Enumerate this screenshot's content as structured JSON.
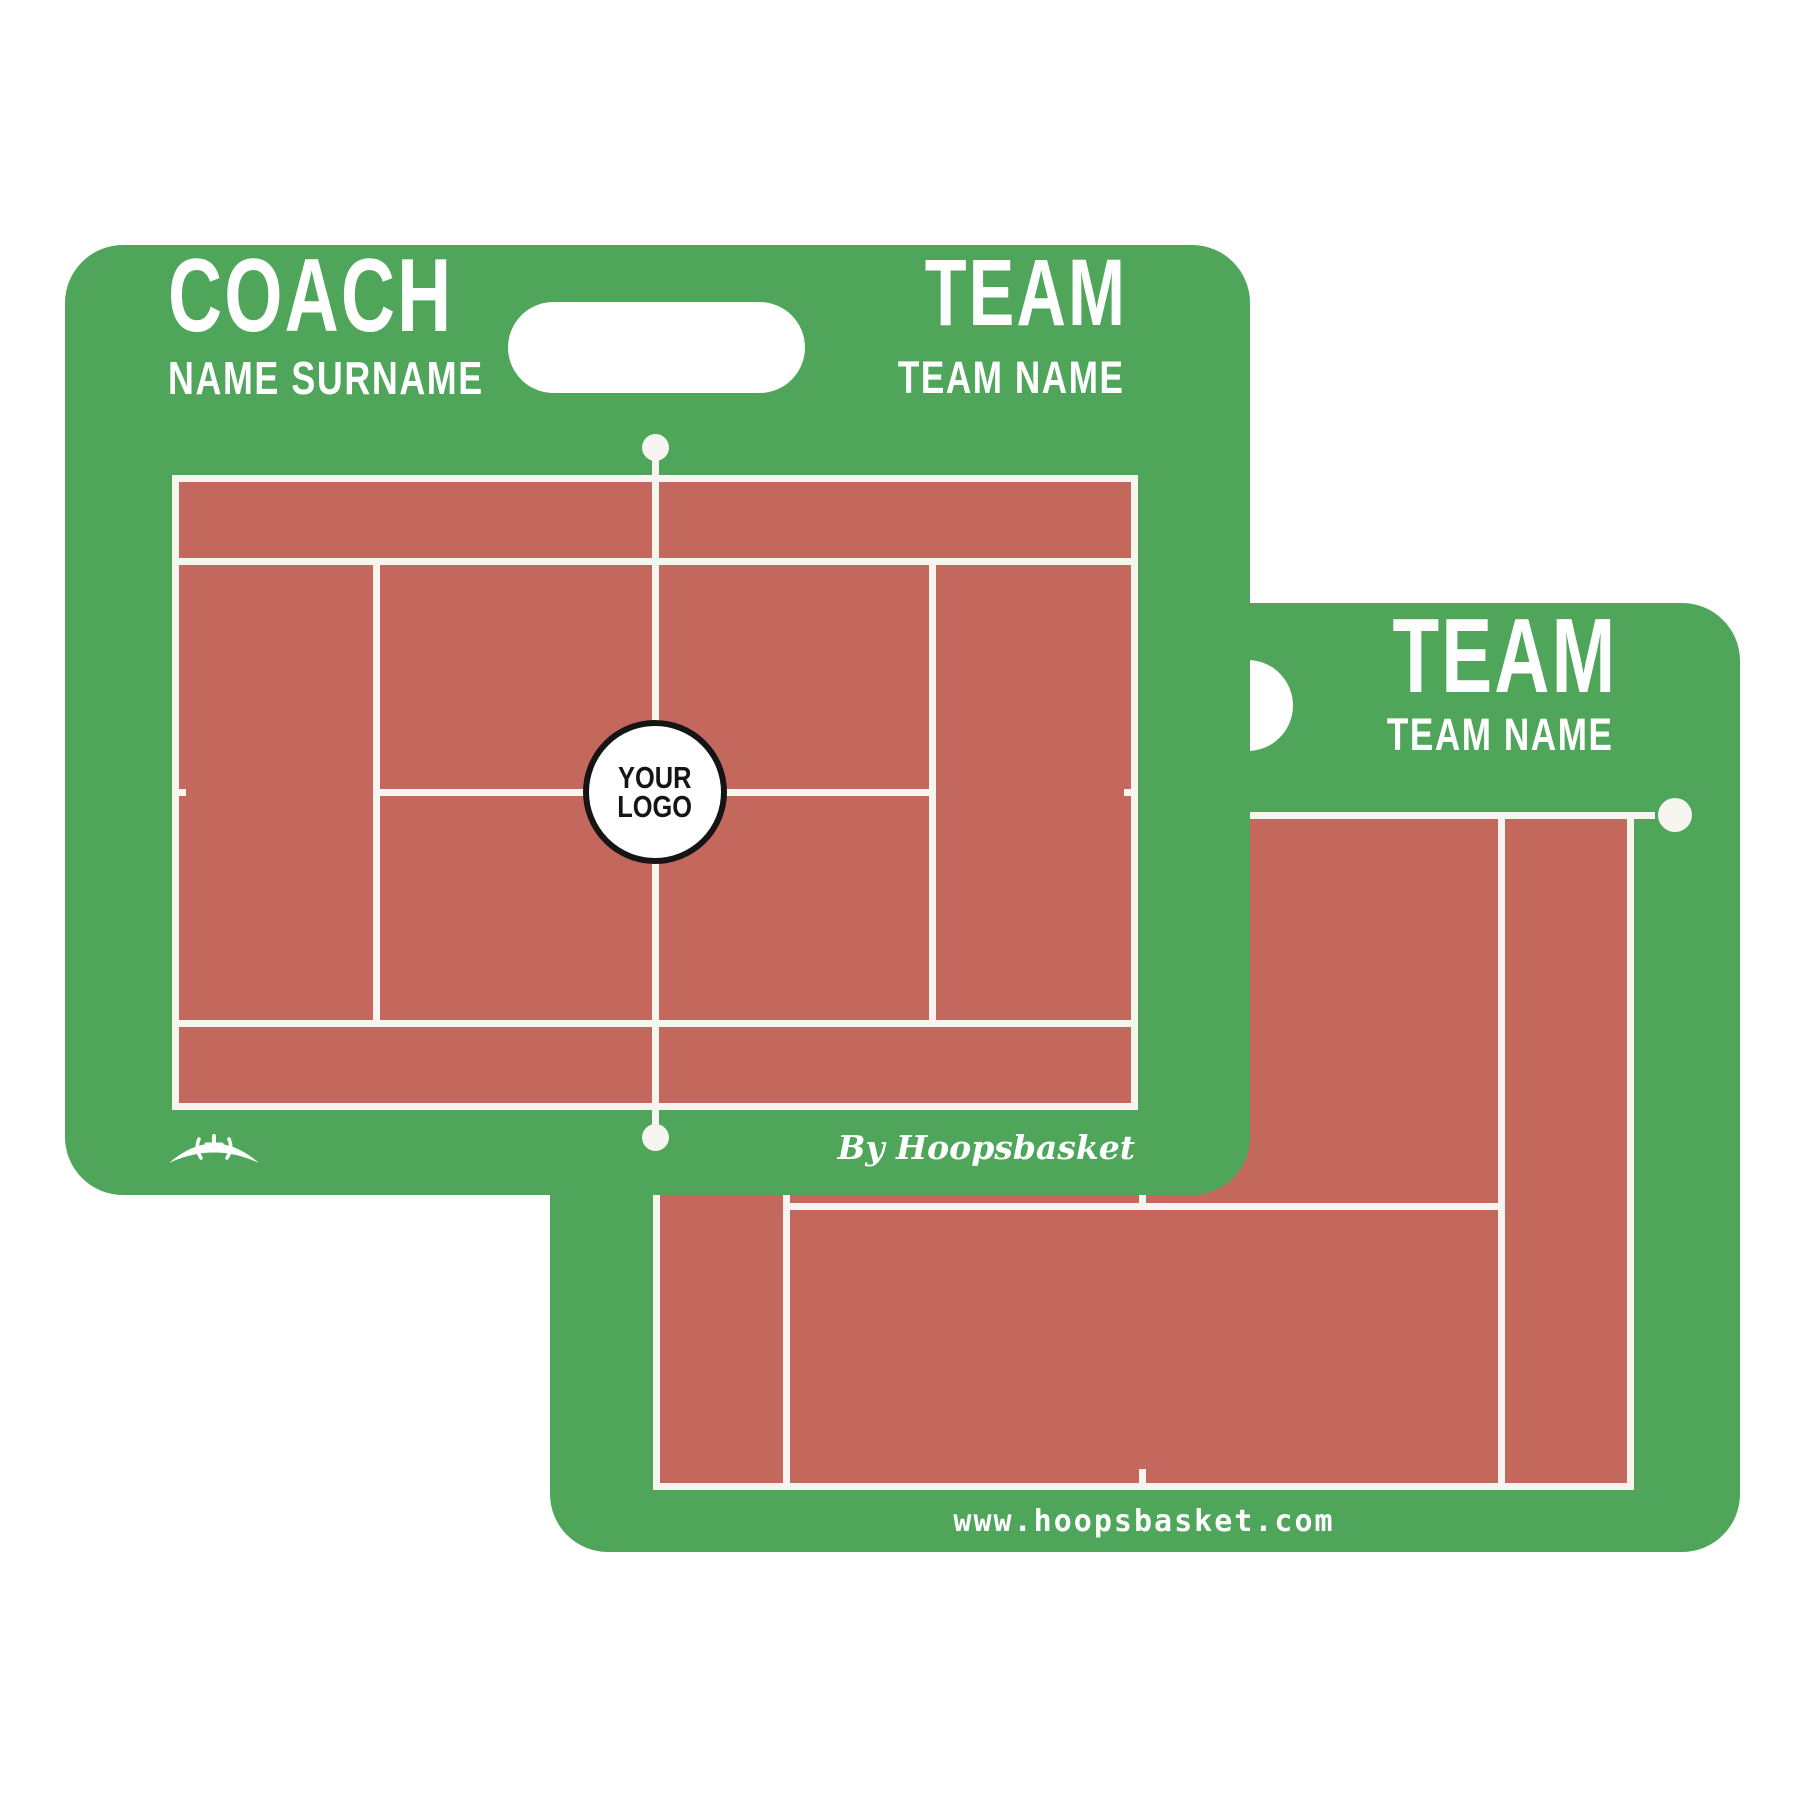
{
  "colors": {
    "board_green": "#4fa65a",
    "court_red": "#c4685e",
    "line_white": "#f7f5f0",
    "logo_text": "#151515",
    "site_text": "#ffffff"
  },
  "front_board": {
    "coach_label": "COACH",
    "coach_name": "NAME SURNAME",
    "team_label": "TEAM",
    "team_name": "TEAM NAME",
    "court_type": "tennis full court diagram",
    "logo_placeholder": {
      "line1": "YOUR",
      "line2": "LOGO"
    },
    "brand_script": "By Hoopsbasket",
    "icons": {
      "basketball_logo": "basketball-dome-icon"
    }
  },
  "back_board": {
    "team_label": "TEAM",
    "team_name": "TEAM NAME",
    "court_type": "tennis half court diagram",
    "website": "www.hoopsbasket.com"
  }
}
